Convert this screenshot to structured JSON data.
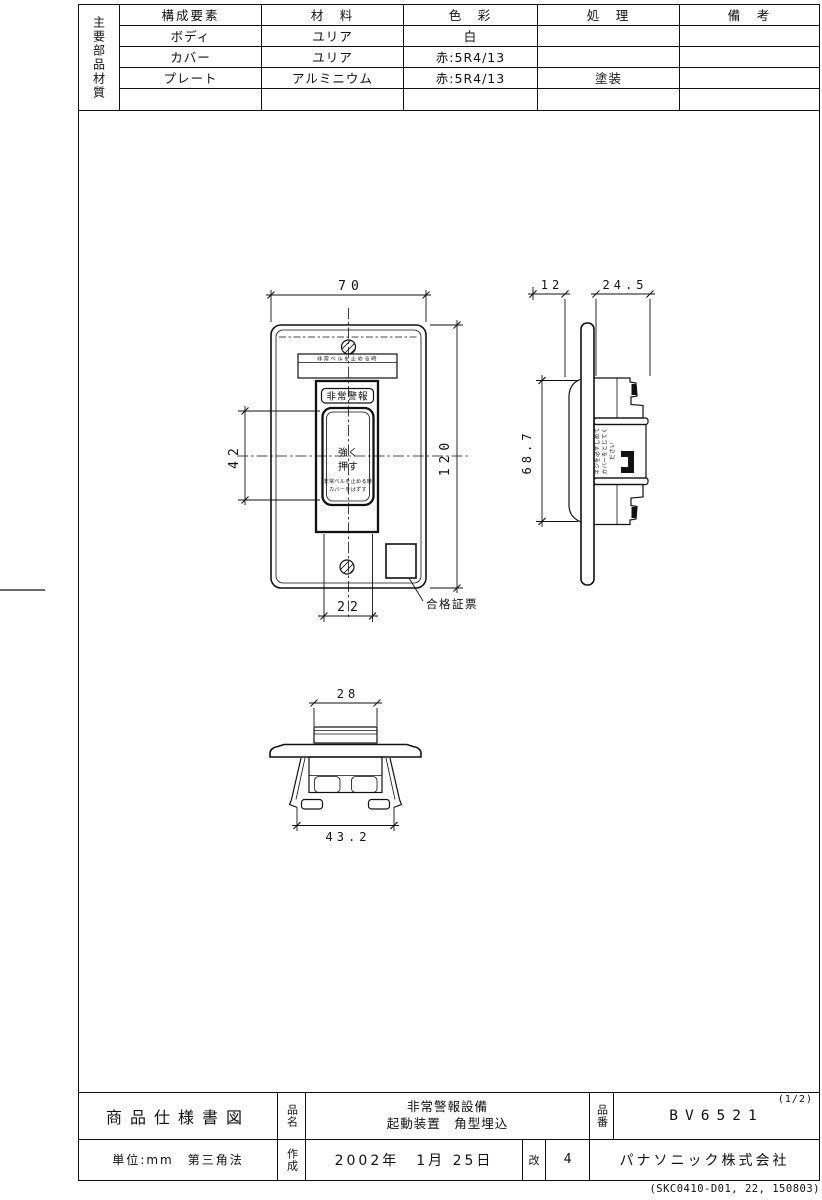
{
  "materials_table": {
    "row_header_vertical": "主要部品材質",
    "columns": [
      "構成要素",
      "材　料",
      "色　彩",
      "処　理",
      "備　考"
    ],
    "rows": [
      {
        "component": "ボディ",
        "material": "ユリア",
        "color": "白",
        "treatment": "",
        "remarks": ""
      },
      {
        "component": "カバー",
        "material": "ユリア",
        "color": "赤:5R4/13",
        "treatment": "",
        "remarks": ""
      },
      {
        "component": "プレート",
        "material": "アルミニウム",
        "color": "赤:5R4/13",
        "treatment": "塗装",
        "remarks": ""
      },
      {
        "component": "",
        "material": "",
        "color": "",
        "treatment": "",
        "remarks": ""
      }
    ]
  },
  "views": {
    "front": {
      "dims": {
        "width": "70",
        "height": "120",
        "button_height": "42",
        "button_width": "22"
      },
      "strip_text": "非常ベルを止める時",
      "cover_label": "非常警報",
      "button_text_line1": "強く",
      "button_text_line2": "押す",
      "button_note_line1": "非常ベルを止める時",
      "button_note_line2": "カバーをはずす",
      "cert_label": "合格証票"
    },
    "side": {
      "dims": {
        "protrusion": "12",
        "depth": "24.5",
        "height": "68.7"
      },
      "note_line1": "ネジを必ずしめて",
      "note_line2": "カバーをとじてく",
      "note_line3": "ださい"
    },
    "bottom": {
      "dims": {
        "top_width": "28",
        "overall_width": "43.2"
      }
    }
  },
  "title_block": {
    "doc_type": "商品仕様書図",
    "name_label": "品名",
    "product_name_line1": "非常警報設備",
    "product_name_line2": "起動装置　角型埋込",
    "number_label": "品番",
    "product_number": "BV6521",
    "page_indicator": "(1/2)",
    "units": "単位:mm　第三角法",
    "created_label": "作成",
    "created_date": "2002年　1月 25日",
    "revision_label": "改",
    "revision": "4",
    "company": "パナソニック株式会社"
  },
  "footer": {
    "doc_code": "(SKC0410-D01, 22, 150803)"
  }
}
